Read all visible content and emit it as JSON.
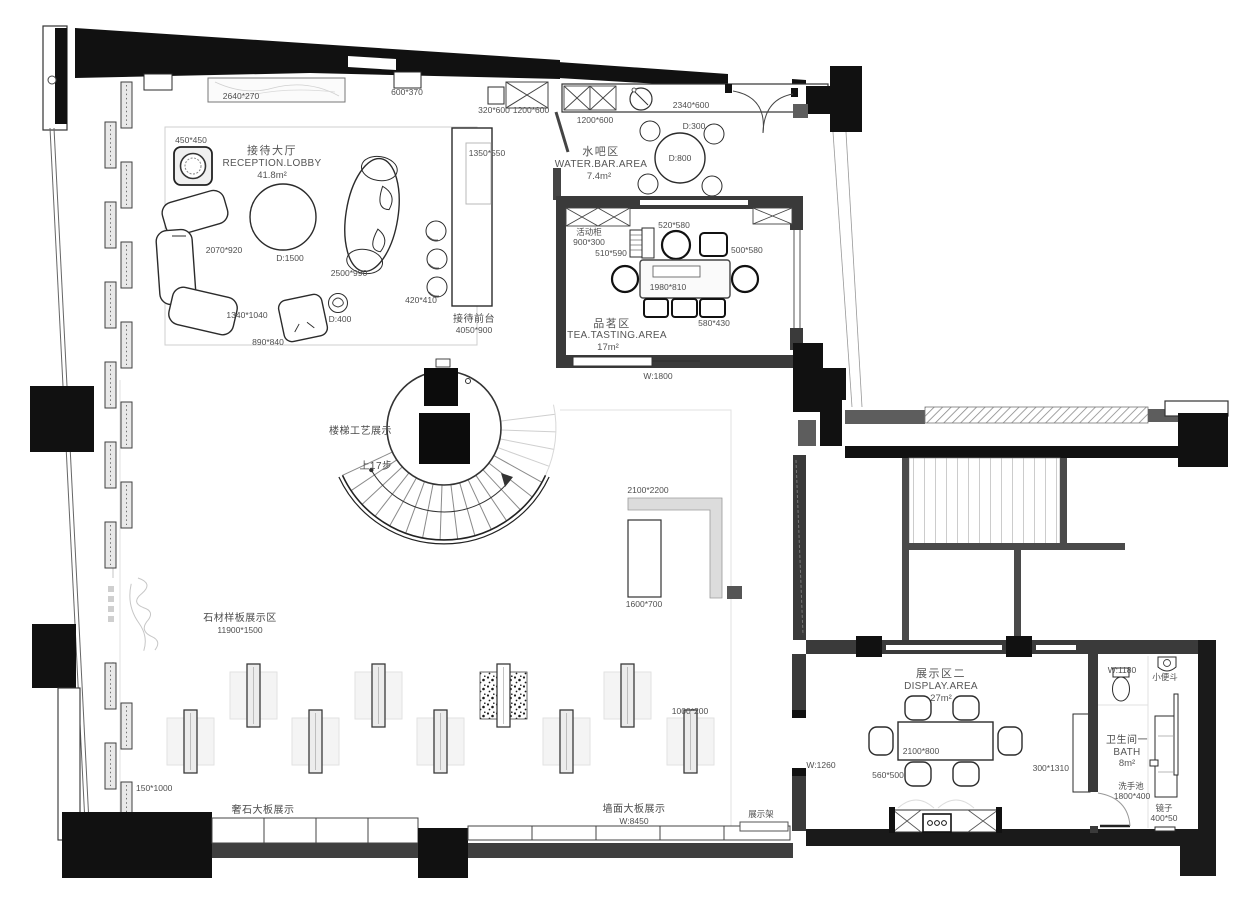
{
  "plan": {
    "top": {
      "marble": "2640*270",
      "box": "600*370",
      "cab_a": "320*600",
      "cab_b": "1200*600"
    },
    "reception": {
      "title_cn": "接待大厅",
      "title_en": "RECEPTION.LOBBY",
      "area": "41.8m²",
      "pot": "450*450",
      "sofa": "2070*920",
      "table": "D:1500",
      "chaise": "2500*990",
      "rug": "1340*1040",
      "pillow": "890*840",
      "side_table": "D:400"
    },
    "desk": {
      "stools": "420*410",
      "inner": "1350*550",
      "name_cn": "接待前台",
      "dim": "4050*900"
    },
    "water_bar": {
      "title_cn": "水吧区",
      "title_en": "WATER.BAR.AREA",
      "area": "7.4m²",
      "counter": "2340*600",
      "cabinet": "1200*600",
      "stool": "D:300",
      "table": "D:800"
    },
    "tea": {
      "title_cn": "品茗区",
      "title_en": "TEA.TASTING.AREA",
      "area": "17m²",
      "mobile_cab_cn": "活动柜",
      "mobile_cab_dim": "900*300",
      "chair_round": "520*580",
      "side_cab": "510*590",
      "chair_square": "500*580",
      "table": "1980*810",
      "stool": "580*430",
      "opening": "W:1800"
    },
    "stair": {
      "title": "楼梯工艺展示",
      "steps": "上17步"
    },
    "island": {
      "dim": "2100*2200",
      "slab": "1600*700"
    },
    "stone": {
      "title": "石材样板展示区",
      "dim": "11900*1500",
      "stand": "1000*200",
      "panel": "150*1000"
    },
    "south": {
      "lux_cn": "奢石大板展示",
      "lux_w": "W:7450",
      "wall_cn": "墙面大板展示",
      "wall_w": "W:8450",
      "rack": "展示架"
    },
    "display2": {
      "title_cn": "展示区二",
      "title_en": "DISPLAY.AREA",
      "area": "27m²",
      "table": "2100*800",
      "chair": "560*500",
      "cabinet": "300*1310",
      "door": "W:1260"
    },
    "bath": {
      "title_cn": "卫生间一",
      "title_en": "BATH",
      "area": "8m²",
      "toilet": "W:1180",
      "urinal": "小便斗",
      "basin_cn": "洗手池",
      "basin_dim": "1800*400",
      "mirror_cn": "镜子",
      "mirror_dim": "400*50"
    }
  }
}
